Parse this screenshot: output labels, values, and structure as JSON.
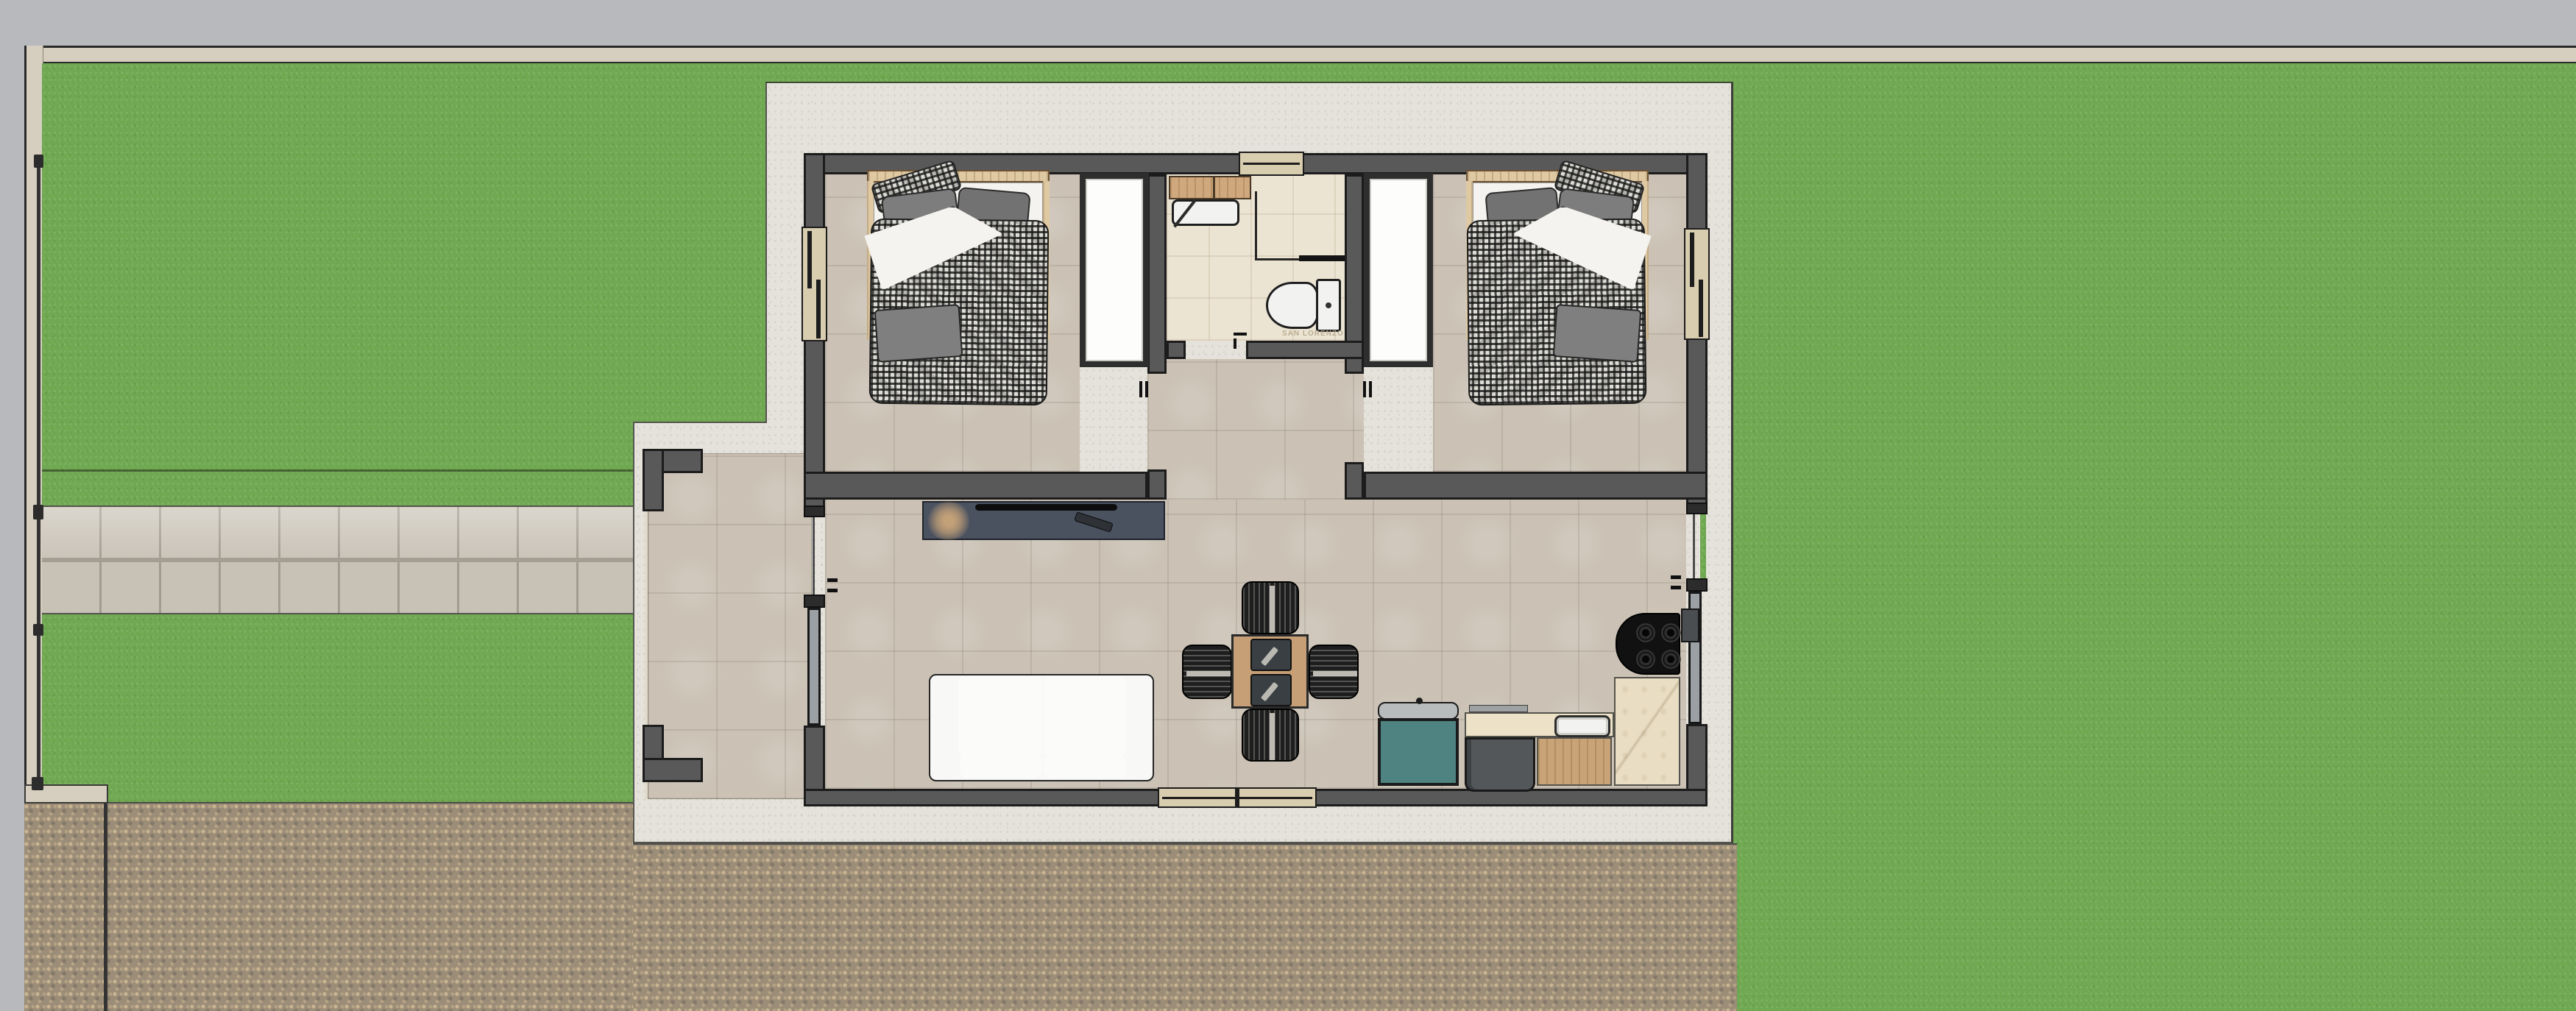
{
  "scene": {
    "type": "floor-plan-top-view",
    "watermark_brand": "SAN LORENZO"
  },
  "colors": {
    "bg_gray": "#b7b9bd",
    "strip_beige": "#d6cfc0",
    "wall_fill": "#595959",
    "wall_outline": "#1c1c1c",
    "grass": "#6fa851",
    "walkway_tile": "#cfc9bd",
    "walkway_joint": "#a8a296",
    "cobble_base": "#9b8d77",
    "cobble_light": "#c8b491",
    "cobble_mid": "#b5a285",
    "cobble_dark": "#84796a",
    "apron": "#e4e2da",
    "floor_tile": "#cbc2b5",
    "bath_tile": "#ece4d2",
    "window_fill": "#d9cdb0",
    "glass_gray": "#9aa0a4",
    "duvet_base": "#dddcd6",
    "pillow_gray": "#7d7d7d",
    "sheet_white": "#f4f3ef",
    "wood_mid": "#c9a47e",
    "wood_light": "#dec9a3",
    "tv_unit": "#4a5260",
    "plant_tan": "#c2a078",
    "sofa_white": "#f8f8f6",
    "chair_black": "#1e1e1e",
    "table_wood": "#c79f76",
    "placemat": "#3a3f44",
    "teal_cabinet": "#4f8381",
    "appliance_gray": "#54575a",
    "counter_cream": "#ede2c8",
    "marble_cream": "#e9ddc4",
    "sink_white": "#f2f2f0",
    "cooktop_black": "#111111",
    "fence_dark": "#333333",
    "watermark": "#b4a88c"
  }
}
